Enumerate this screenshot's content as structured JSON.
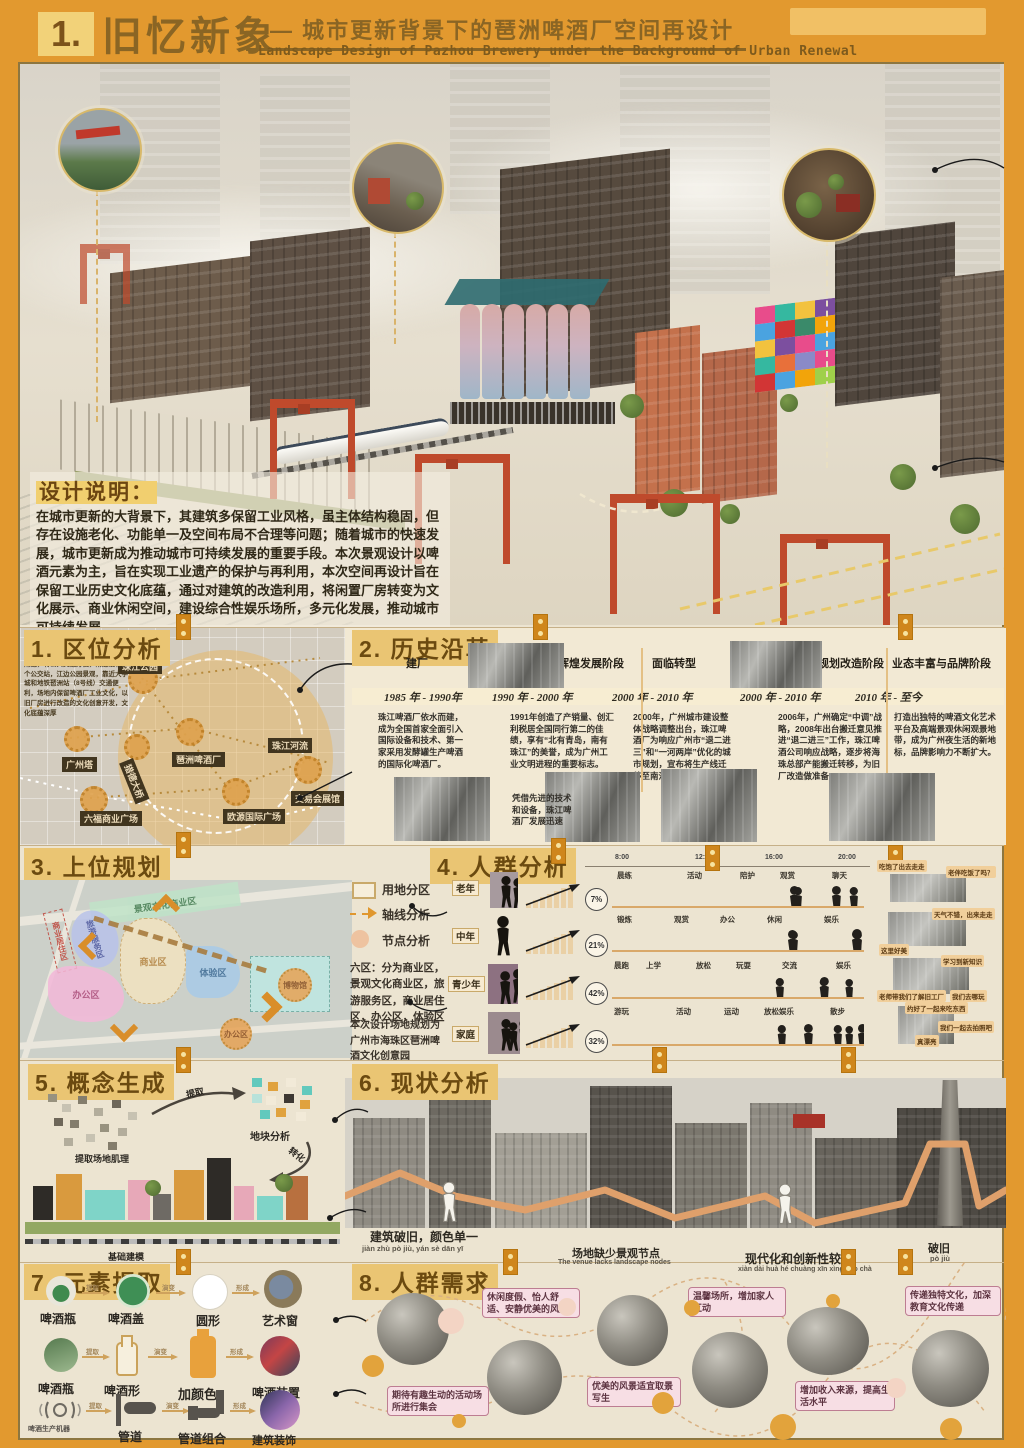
{
  "header": {
    "number": "1.",
    "title": "旧忆新象",
    "dash": "——",
    "subtitle_cn": "城市更新背景下的琶洲啤酒厂空间再设计",
    "subtitle_en": "Landscape Design of Pazhou Brewery under the Background of Urban Renewal"
  },
  "design_note": {
    "label": "设计说明：",
    "body": "在城市更新的大背景下，其建筑多保留工业风格，虽主体结构稳固，但存在设施老化、功能单一及空间布局不合理等问题；随着城市的快速发展，城市更新成为推动城市可持续发展的重要手段。本次景观设计以啤酒元素为主，旨在实现工业遗产的保护与再利用，本次空间再设计旨在保留工业历史文化底蕴，通过对建筑的改造利用，将闲置厂房转变为文化展示、商业休闲空间，建设综合性娱乐场所，多元化发展，推动城市可持续发展。"
  },
  "s1": {
    "title": "1. 区位分析",
    "intro": "位于海珠区琶洲街道新港东路119号附近，有公共交通方便，附近设有多个公交站，江边公园景观，靠近大学城和地铁琶洲站（8号线）交通便利，场地内保留啤酒厂工业文化，以旧厂房进行改造的文化创意开发，文化底蕴深厚",
    "labels": {
      "park": "珠江公园",
      "tower": "广州塔",
      "brewery": "琶洲啤酒厂",
      "bridge": "猎德大桥",
      "river": "珠江河流",
      "expo": "交易会展馆",
      "liufu": "六福商业广场",
      "ouyuan": "欧源国际广场"
    }
  },
  "s2": {
    "title": "2. 历史沿革",
    "phases": [
      "建厂",
      "辉煌发展阶段",
      "面临转型",
      "规划改造阶段",
      "业态丰富与品牌阶段"
    ],
    "dates": [
      "1985 年 - 1990年",
      "1990 年 - 2000 年",
      "2000 年 - 2010 年",
      "2000 年 - 2010 年",
      "2010 年 - 至今"
    ],
    "texts": [
      "珠江啤酒厂依水而建，成为全国首家全面引入国际设备和技术、第一家采用发酵罐生产啤酒的国际化啤酒厂。",
      "1991年创造了产销量、创汇利税居全国同行第二的佳绩，享有“北有青岛，南有珠江”的美誉，成为广州工业文明进程的重要标志。",
      "2000年，广州城市建设整体战略调整出台，珠江啤酒厂为响应广州市“退二进三”和“一河两岸”优化的城市规划，宣布将生产线迁移至南沙。",
      "2006年，广州确定“中调”战略，2008年出台搬迁意见推进“退二进三”工作，珠江啤酒公司响应战略，逐步将海珠总部产能搬迁转移，为旧厂改造做准备。",
      "打造出独特的啤酒文化艺术平台及高端景观休闲观景地带，成为广州夜生活的新地标，品牌影响力不断扩大。"
    ],
    "note": "凭借先进的技术和设备，珠江啤酒厂发展迅速"
  },
  "s3": {
    "title": "3. 上位规划",
    "zones": {
      "landscape": "景观文化商业区",
      "residence": "商业居住区",
      "tourism": "旅游服务区",
      "business": "商业区",
      "experience": "体验区",
      "museum": "博物馆",
      "office1": "办公区",
      "office2": "办公区"
    }
  },
  "legend": {
    "item1": "用地分区",
    "item2": "轴线分析",
    "item3": "节点分析",
    "para1": "六区：分为商业区，景观文化商业区，旅游服务区，商业居住区，办公区，体验区",
    "para2": "本次设计场地规划为广州市海珠区琶洲啤酒文化创意园"
  },
  "s4": {
    "title": "4. 人群分析",
    "times": [
      "8:00",
      "12:00",
      "16:00",
      "20:00"
    ],
    "groups": [
      {
        "label": "老年",
        "pct": "7%",
        "acts": [
          "晨练",
          "活动",
          "陪护",
          "观赏",
          "聊天"
        ]
      },
      {
        "label": "中年",
        "pct": "21%",
        "acts": [
          "锻炼",
          "观赏",
          "办公",
          "休闲",
          "娱乐"
        ]
      },
      {
        "label": "青少年",
        "pct": "42%",
        "acts": [
          "晨跑",
          "上学",
          "放松",
          "玩耍",
          "交流",
          "娱乐"
        ]
      },
      {
        "label": "家庭",
        "pct": "32%",
        "acts": [
          "游玩",
          "活动",
          "运动",
          "放松娱乐",
          "散步"
        ]
      }
    ],
    "bubbles": [
      "吃饱了出去走走",
      "老伴吃饭了吗？",
      "天气不错，出来走走",
      "这里好美",
      "学习到新知识",
      "老师带我们了解旧工厂",
      "我们去哪玩",
      "约好了一起来吃东西",
      "我们一起去拍照吧",
      "真漂亮"
    ]
  },
  "s5": {
    "title": "5. 概念生成",
    "l1": "提取场地肌理",
    "a1": "提取",
    "l2": "地块分析",
    "a2": "转化",
    "l3": "基础建模"
  },
  "s6": {
    "title": "6. 现状分析",
    "captions": [
      {
        "cn": "建筑破旧，颜色单一",
        "sub": "jiàn zhù pò jiù, yán sè dān yī"
      },
      {
        "cn": "场地缺少景观节点",
        "sub": "The venue lacks landscape nodes"
      },
      {
        "cn": "现代化和创新性较差",
        "sub": "xiàn dài huà hé chuàng xīn xìng jiào chà"
      },
      {
        "cn": "破旧",
        "sub": "pò jiù"
      }
    ]
  },
  "s7": {
    "title": "7. 元素提取",
    "arrow1": "提取",
    "arrow2": "演变",
    "arrow3": "形成",
    "rows": [
      {
        "s1": "啤酒瓶",
        "s2": "啤酒盖",
        "s3": "圆形",
        "s4": "艺术窗"
      },
      {
        "s1": "啤酒瓶",
        "s2": "啤酒形",
        "s3": "加颜色",
        "s4": "啤酒装置"
      },
      {
        "s1": "啤酒生产机器",
        "s2": "管道",
        "s3": "管道组合",
        "s4": "建筑装饰"
      }
    ]
  },
  "s8": {
    "title": "8. 人群需求",
    "bubbles": [
      "休闲度假、怡人舒适、安静优美的风景",
      "期待有趣生动的活动场所进行集会",
      "优美的风景适宜取景写生",
      "温馨场所，增加家人互动",
      "增加收入来源，提高生活水平",
      "传递独特文化，加深教育文化传递"
    ]
  },
  "colors": {
    "page_orange": "#e2992f",
    "panel_cream": "#ece4d1",
    "heading_brown": "#6b4a10",
    "highlight_tan": "#eac573",
    "crane_red": "#bf4a2c",
    "connector_orange": "#cf861c"
  }
}
